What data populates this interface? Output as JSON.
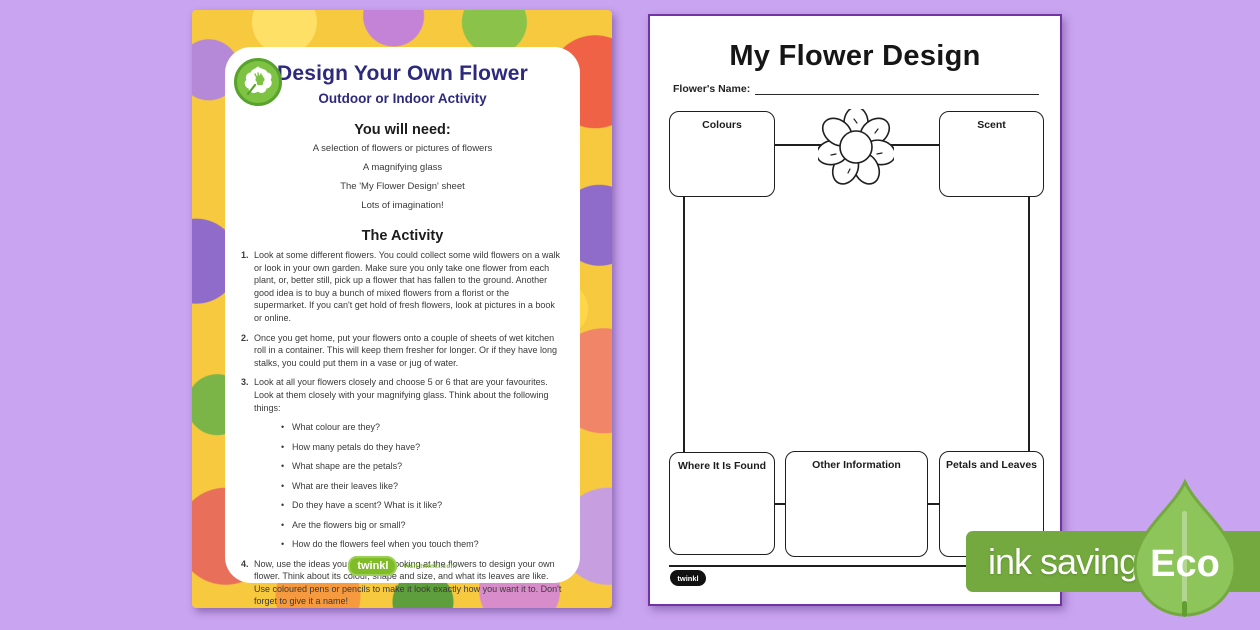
{
  "left_page": {
    "title": "Design Your Own Flower",
    "subtitle": "Outdoor or Indoor Activity",
    "you_will_need": {
      "heading": "You will need:",
      "items": [
        "A selection of flowers or pictures of flowers",
        "A magnifying glass",
        "The 'My Flower Design' sheet",
        "Lots of imagination!"
      ]
    },
    "activity": {
      "heading": "The Activity",
      "steps": [
        {
          "number": "1.",
          "text": "Look at some different flowers. You could collect some wild flowers on a walk or look in your own garden. Make sure you only take one flower from each plant, or, better still, pick up a flower that has fallen to the ground. Another good idea is to buy a bunch of mixed flowers from a florist or the supermarket. If you can't get hold of fresh flowers, look at pictures in a book or online."
        },
        {
          "number": "2.",
          "text": "Once you get home, put your flowers onto a couple of sheets of wet kitchen roll in a container. This will keep them fresher for longer. Or if they have long stalks, you could put them in a vase or jug of water."
        },
        {
          "number": "3.",
          "text": "Look at all your flowers closely and choose 5 or 6 that are your favourites. Look at them closely with your magnifying glass. Think about the following things:",
          "bullets": [
            "What colour are they?",
            "How many petals do they have?",
            "What shape are the petals?",
            "What are their leaves like?",
            "Do they have a scent? What is it like?",
            "Are the flowers big or small?",
            "How do the flowers feel when you touch them?"
          ]
        },
        {
          "number": "4.",
          "text": "Now, use the ideas you have from looking at the flowers to design your own flower. Think about its colour, shape and size, and what its leaves are like. Use coloured pens or pencils to make it look exactly how you want it to. Don't forget to give it a name!"
        }
      ]
    },
    "footer": {
      "logo": "twinkl",
      "tagline": "visit twinkl.com"
    }
  },
  "right_page": {
    "title": "My Flower Design",
    "name_label": "Flower's Name:",
    "boxes": {
      "colours": "Colours",
      "scent": "Scent",
      "where": "Where It Is Found",
      "other": "Other Information",
      "petals": "Petals and Leaves"
    },
    "footer_logo": "twinkl"
  },
  "badge": {
    "label": "ink saving",
    "eco": "Eco",
    "band_color": "#74a93f",
    "leaf_color": "#8ec55b"
  },
  "colors": {
    "background": "#c9a4f0",
    "page_border": "#7233a5",
    "heading_navy": "#2d2a7e",
    "twinkl_green": "#80bc28"
  }
}
